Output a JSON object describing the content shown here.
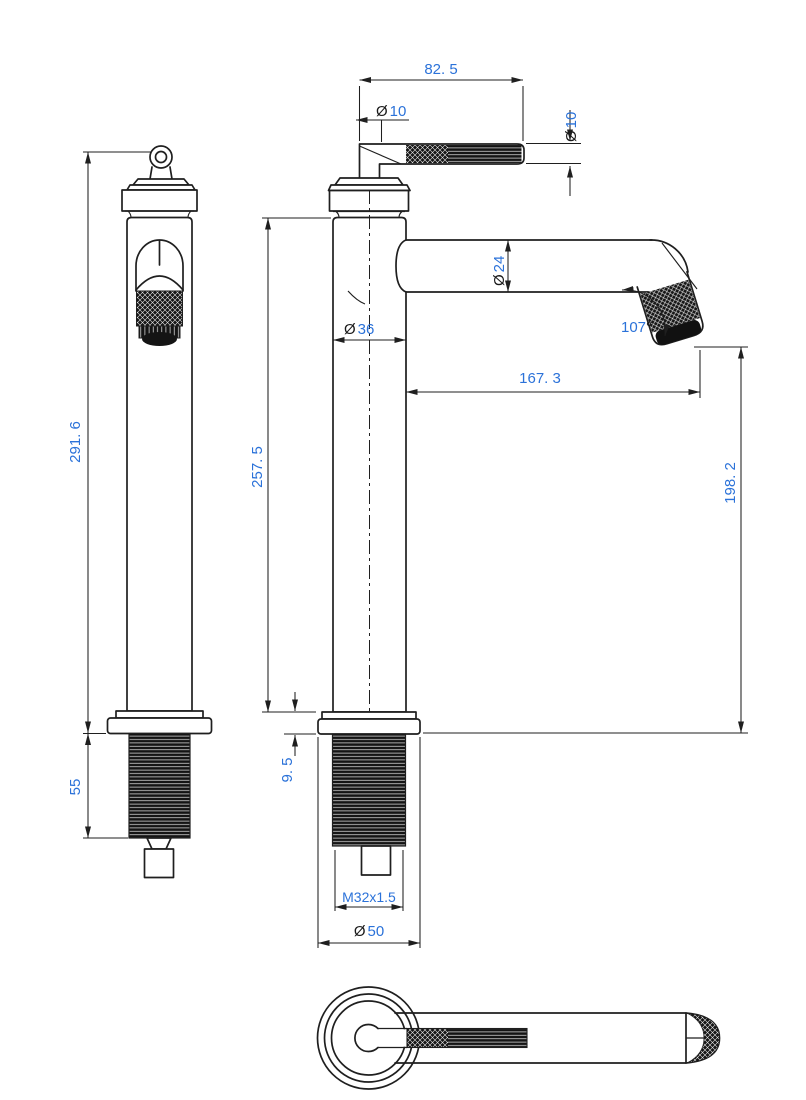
{
  "drawing": {
    "title": "Tall basin mixer tap — three-view dimensional drawing",
    "views": {
      "side": "side-view",
      "front": "front-view",
      "top": "top-view"
    },
    "colors": {
      "line": "#1f1f1f",
      "dim_value": "#2b72d9",
      "dim_symbol": "#1a1a1a",
      "background": "#ffffff"
    }
  },
  "dims": {
    "handle_length": {
      "value": "82. 5"
    },
    "handle_stem_dia": {
      "prefix": "Ø",
      "value": "10"
    },
    "handle_rod_dia": {
      "prefix": "Ø",
      "value": "10"
    },
    "spout_tube_dia": {
      "prefix": "Ø",
      "value": "24"
    },
    "body_dia": {
      "prefix": "Ø",
      "value": "36"
    },
    "spout_angle": {
      "value": "107",
      "suffix": "°"
    },
    "spout_reach": {
      "value": "167. 3"
    },
    "overall_height": {
      "value": "291. 6"
    },
    "body_height": {
      "value": "257. 5"
    },
    "outlet_height": {
      "value": "198. 2"
    },
    "shank_length": {
      "value": "55"
    },
    "base_thickness": {
      "value": "9. 5"
    },
    "shank_thread": {
      "value": "M32x1.5"
    },
    "base_dia": {
      "prefix": "Ø",
      "value": "50"
    }
  }
}
